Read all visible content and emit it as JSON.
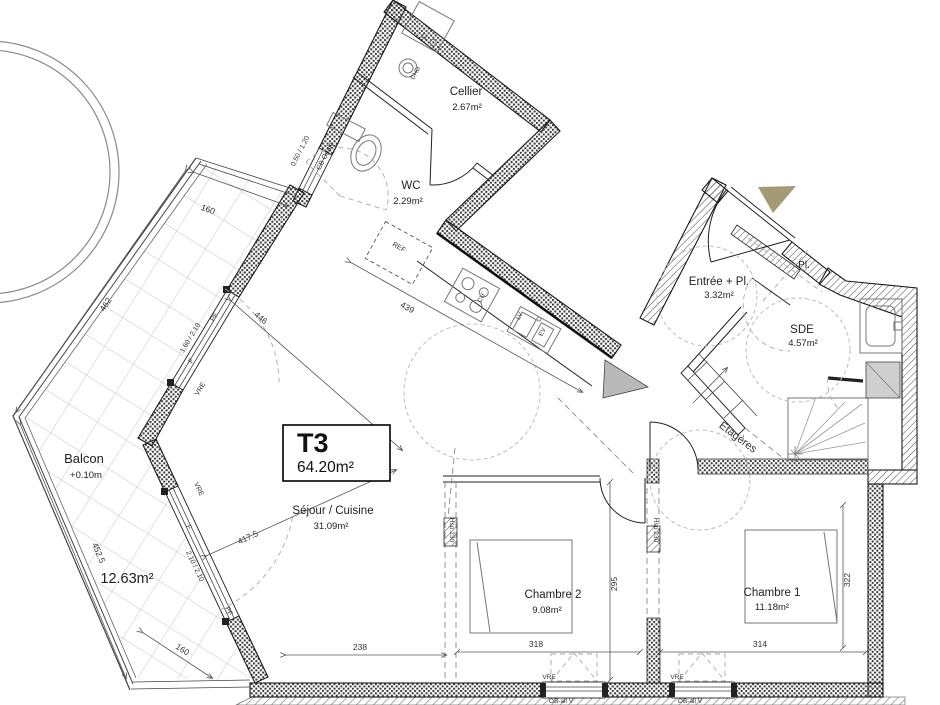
{
  "unit": {
    "code": "T3",
    "area": "64.20m²"
  },
  "rooms": {
    "cellier": {
      "name": "Cellier",
      "area": "2.67m²"
    },
    "wc": {
      "name": "WC",
      "area": "2.29m²"
    },
    "entree": {
      "name": "Entrée + Pl.",
      "area": "3.32m²"
    },
    "placard": {
      "name": "Pl."
    },
    "sde": {
      "name": "SDE",
      "area": "4.57m²"
    },
    "sejour": {
      "name": "Séjour / Cuisine",
      "area": "31.09m²"
    },
    "chambre2": {
      "name": "Chambre 2",
      "area": "9.08m²"
    },
    "chambre1": {
      "name": "Chambre 1",
      "area": "11.18m²"
    },
    "balcon": {
      "name": "Balcon",
      "level": "+0.10m",
      "area": "12.63m²"
    }
  },
  "dims": {
    "balcony_top": "160",
    "balcony_nw": "462",
    "balcony_sw": "452.5",
    "balcony_tip": "160",
    "kitchen_wall": "439",
    "sejour_nw": "446",
    "sejour_sw": "417.5",
    "sejour_bottom": "238",
    "chambre2_width": "318",
    "chambre2_depth": "295",
    "chambre1_width": "314",
    "chambre1_depth": "322"
  },
  "windows": {
    "nw_balcony": {
      "size": "1.60 / 2.10",
      "type": "PF",
      "fixed": "F",
      "shutter": "VRE"
    },
    "sw_balcony": {
      "size": "2.10 / 2.10",
      "type": "PF",
      "fixed": "F",
      "shutter": "VRE"
    },
    "cellier": {
      "size": "0.50 / 1.20",
      "type": "CB Opale"
    },
    "chambre2": {
      "label": "OB-all V",
      "shutter": "VRE"
    },
    "chambre1": {
      "label": "OB-all V",
      "shutter": "VRE"
    }
  },
  "annotations": {
    "ceiling_left": "Hsp 230",
    "ceiling_right": "Hsp 230",
    "shelves": "Etagères",
    "fridge": "REF",
    "cooktop": "CU",
    "dishwasher": "LV",
    "sink": "EV",
    "washer": "LL",
    "boiler": "CHD"
  },
  "colors": {
    "entry_arrow": "#a59a76"
  }
}
